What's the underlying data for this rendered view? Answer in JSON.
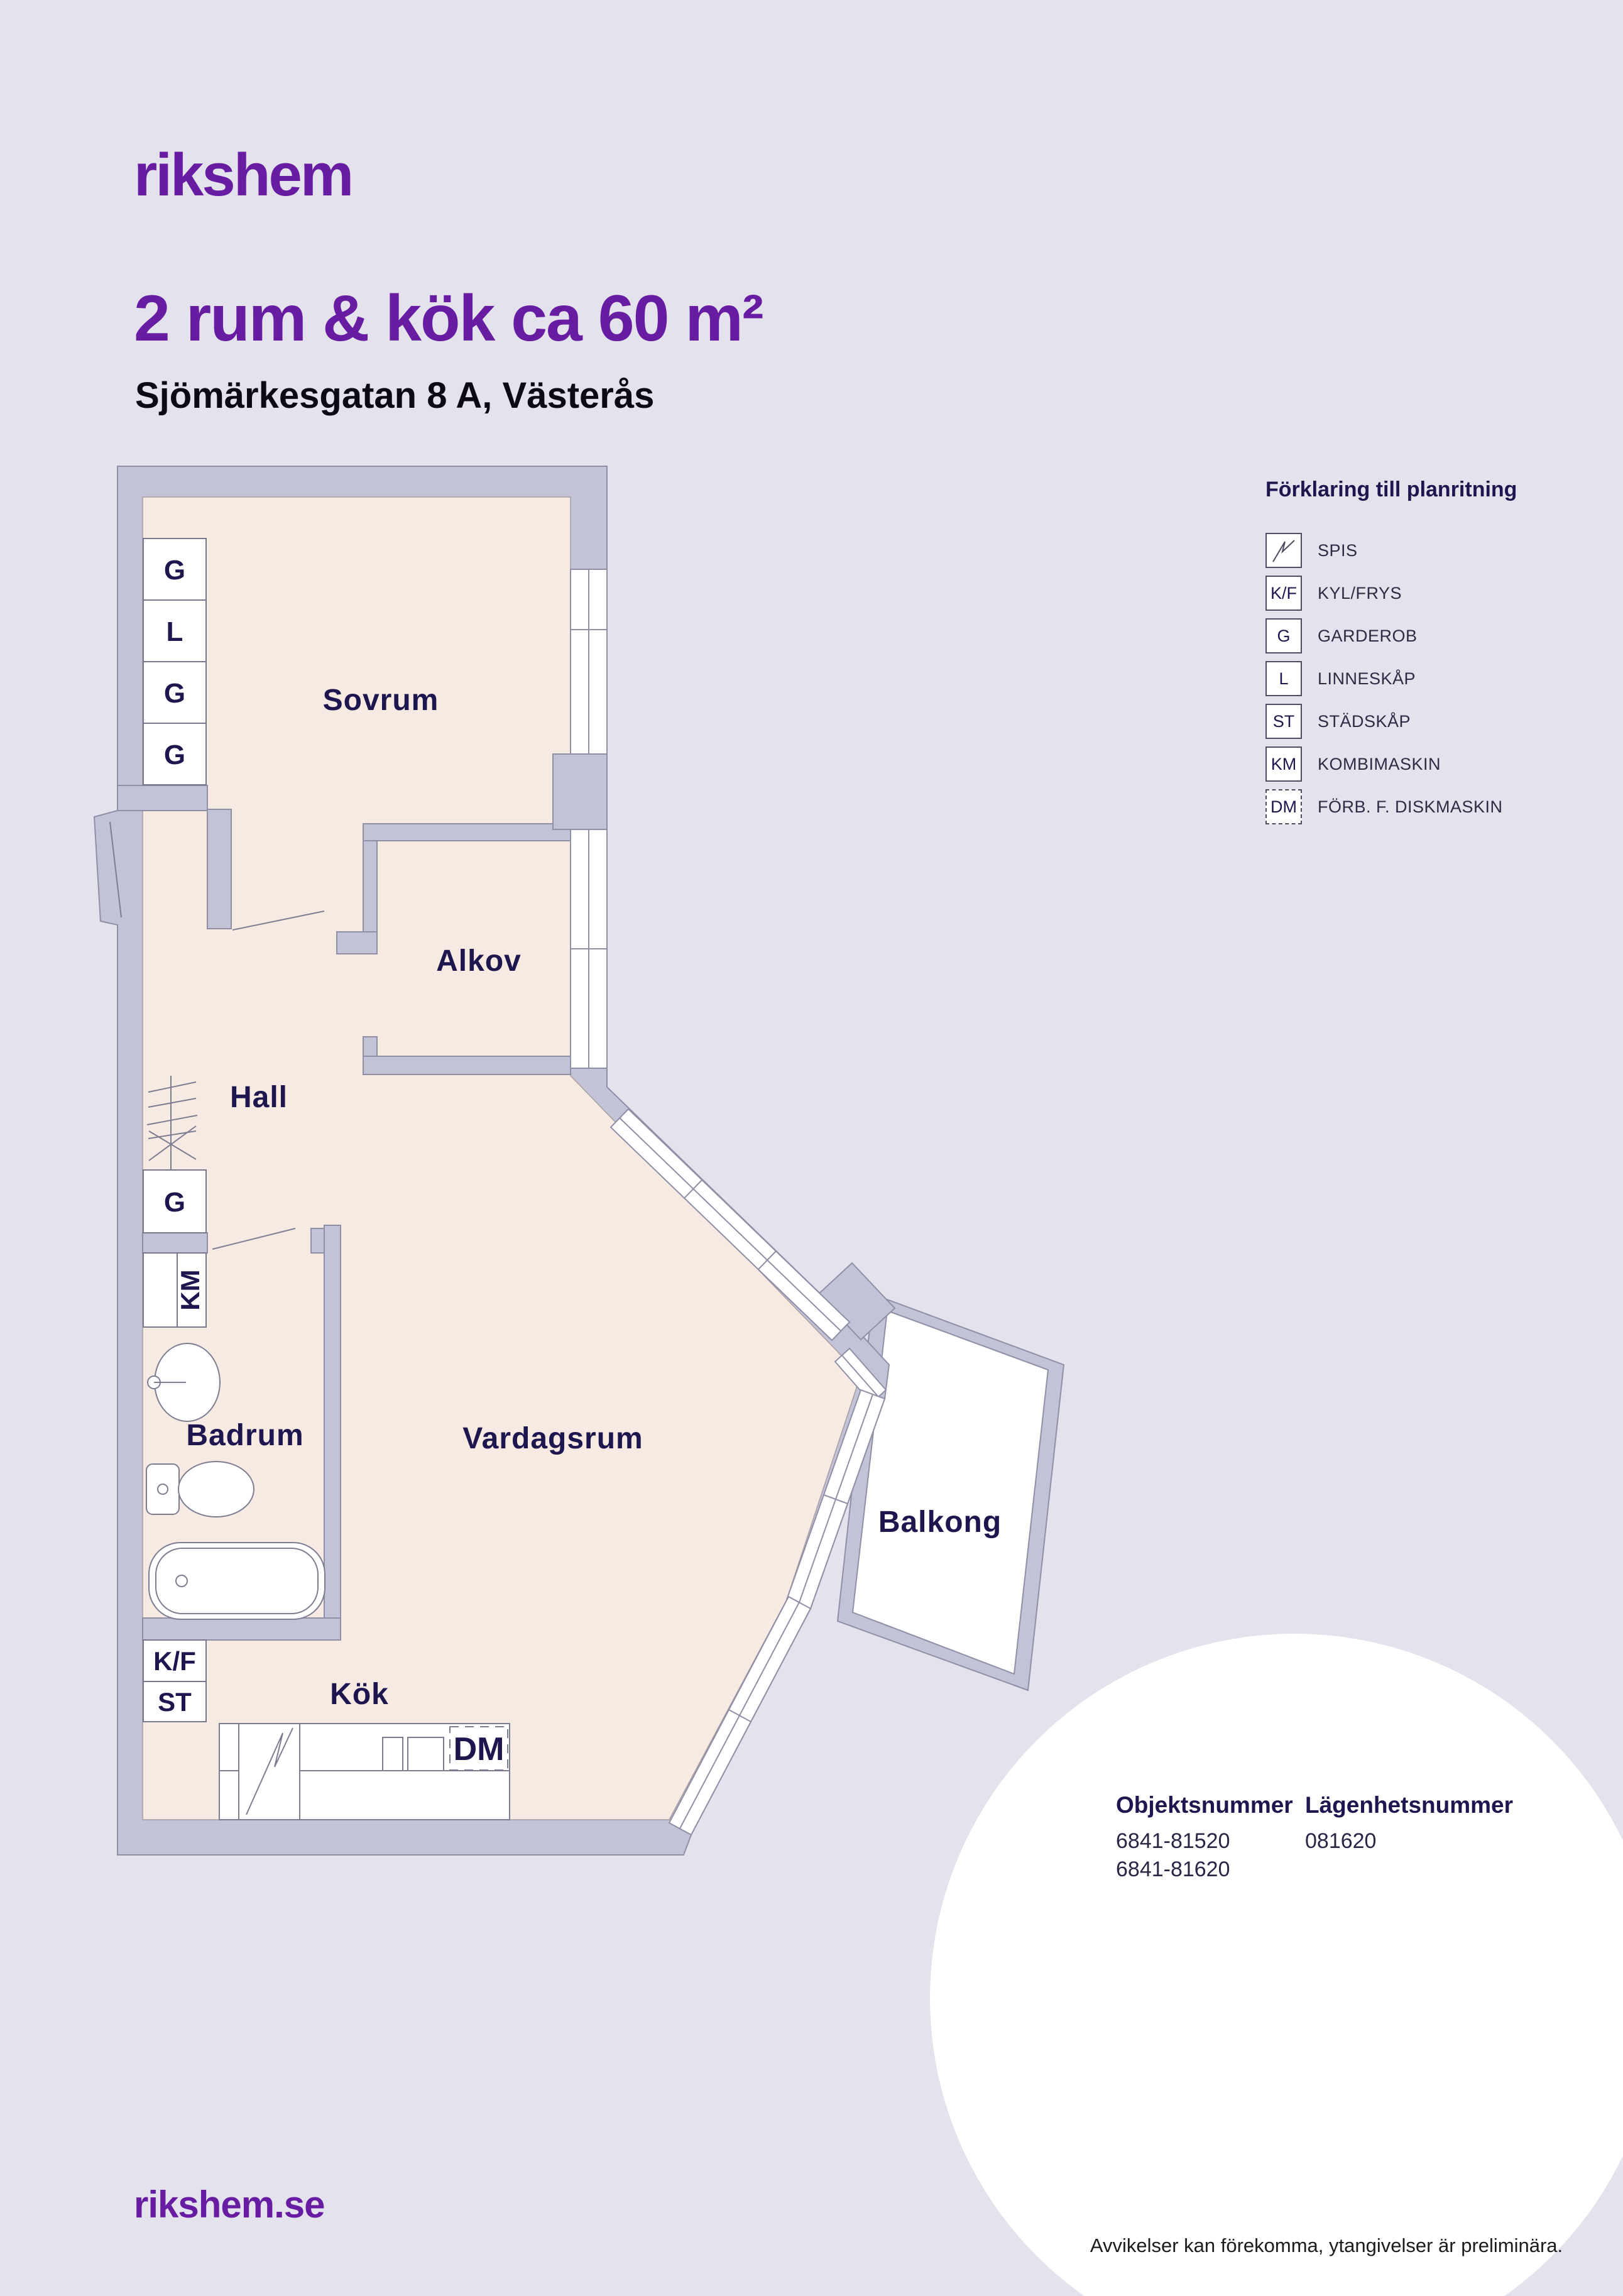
{
  "colors": {
    "background": "#E3E2ED",
    "wall": "#C2C3D7",
    "wall_line": "#8F8FA6",
    "floor": "#F7EAE2",
    "navy": "#1D164F",
    "purple": "#671CA1",
    "white": "#FFFFFF"
  },
  "header": {
    "logo": "rikshem",
    "title": "2 rum & kök ca 60 m²",
    "subtitle": "Sjömärkesgatan 8 A, Västerås"
  },
  "legend": {
    "title": "Förklaring till planritning",
    "items": [
      {
        "code": "",
        "label": "SPIS",
        "icon": "spis-zigzag"
      },
      {
        "code": "K/F",
        "label": "KYL/FRYS"
      },
      {
        "code": "G",
        "label": "GARDEROB"
      },
      {
        "code": "L",
        "label": "LINNESKÅP"
      },
      {
        "code": "ST",
        "label": "STÄDSKÅP"
      },
      {
        "code": "KM",
        "label": "KOMBIMASKIN"
      },
      {
        "code": "DM",
        "label": "FÖRB. F. DISKMASKIN",
        "dashed": true
      }
    ]
  },
  "floorplan": {
    "rooms": {
      "sovrum": "Sovrum",
      "alkov": "Alkov",
      "hall": "Hall",
      "badrum": "Badrum",
      "vardagsrum": "Vardagsrum",
      "kok": "Kök",
      "balkong": "Balkong"
    },
    "closets": {
      "top1": "G",
      "top2": "L",
      "top3": "G",
      "top4": "G",
      "hall": "G",
      "washer": "KM",
      "fridge": "K/F",
      "cleaning": "ST",
      "dishwasher": "DM"
    }
  },
  "footer": {
    "website": "rikshem.se",
    "object_number": {
      "label": "Objektsnummer",
      "values": [
        "6841-81520",
        "6841-81620"
      ]
    },
    "apartment_number": {
      "label": "Lägenhetsnummer",
      "value": "081620"
    },
    "disclaimer": "Avvikelser kan förekomma, ytangivelser är preliminära."
  }
}
